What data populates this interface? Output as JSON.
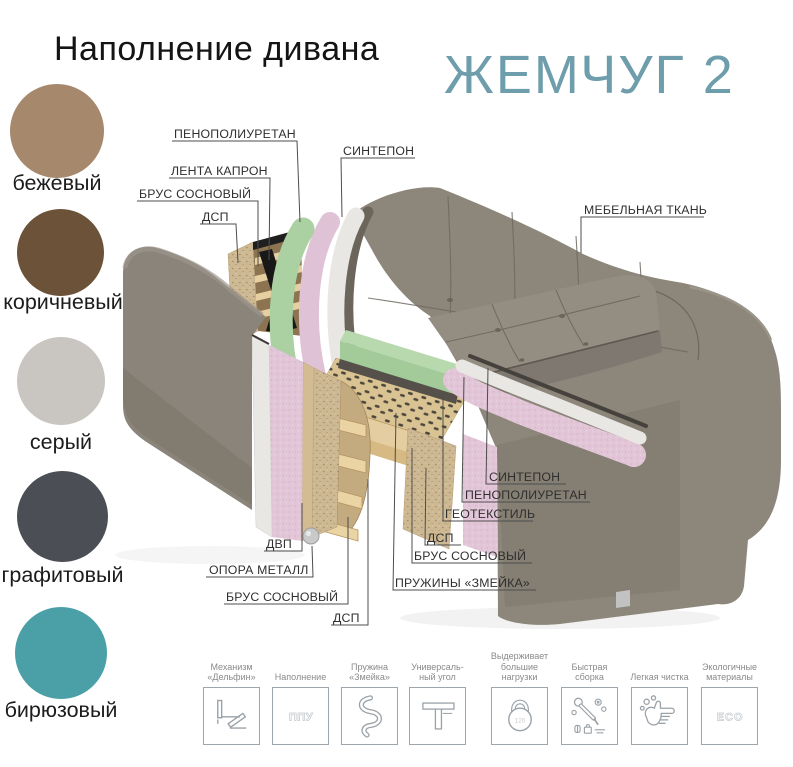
{
  "header": {
    "title": "Наполнение дивана",
    "model": "ЖЕМЧУГ 2"
  },
  "palette": {
    "model_accent": "#6e9dab",
    "leader_line": "#4d4d4d",
    "foam_green": "#abd0a2",
    "foam_pink": "#e2c6d8",
    "sintepon_white": "#e9e7e4",
    "wood": "#e4cda0",
    "fabric_gray": "#8d867b"
  },
  "fabric_swatches": [
    {
      "name": "бежевый",
      "color": "#a6886d"
    },
    {
      "name": "коричневый",
      "color": "#6b5239"
    },
    {
      "name": "серый",
      "color": "#c9c5c1"
    },
    {
      "name": "графитовый",
      "color": "#4b4f55"
    },
    {
      "name": "бирюзовый",
      "color": "#4aa0a6"
    }
  ],
  "diagram": {
    "labels": {
      "penopoliuretan_top": "ПЕНОПОЛИУРЕТАН",
      "sintepon_top": "СИНТЕПОН",
      "lenta_kapron": "ЛЕНТА КАПРОН",
      "brus_sosnovy_top": "БРУС СОСНОВЫЙ",
      "dsp_top": "ДСП",
      "mebelnaya_tkan": "МЕБЕЛЬНАЯ ТКАНЬ",
      "sintepon_bottom": "СИНТЕПОН",
      "penopoliuretan_bottom": "ПЕНОПОЛИУРЕТАН",
      "geotekstil": "ГЕОТЕКСТИЛЬ",
      "dsp_middle": "ДСП",
      "brus_sosnovy_middle": "БРУС СОСНОВЫЙ",
      "pruzhiny_zmeyka": "ПРУЖИНЫ «ЗМЕЙКА»",
      "dvp": "ДВП",
      "opora_metall": "ОПОРА МЕТАЛЛ",
      "brus_sosnovy_left": "БРУС СОСНОВЫЙ",
      "dsp_left": "ДСП"
    }
  },
  "features": [
    {
      "caption": "Механизм\n«Дельфин»",
      "icon": "dolphin-mechanism-icon"
    },
    {
      "caption": "Наполнение",
      "icon": "ppu-filling-icon",
      "badge": "ППУ"
    },
    {
      "caption": "Пружина\n«Змейка»",
      "icon": "snake-spring-icon"
    },
    {
      "caption": "Универсаль-\nный угол",
      "icon": "universal-corner-icon"
    },
    {
      "caption": "Выдерживает\nбольшие\nнагрузки",
      "icon": "weight-load-icon",
      "badge": "120"
    },
    {
      "caption": "Быстрая\nсборка",
      "icon": "quick-assembly-icon"
    },
    {
      "caption": "Легкая чистка",
      "icon": "easy-cleaning-icon"
    },
    {
      "caption": "Экологичные\nматериалы",
      "icon": "eco-materials-icon",
      "badge": "ECO"
    }
  ]
}
